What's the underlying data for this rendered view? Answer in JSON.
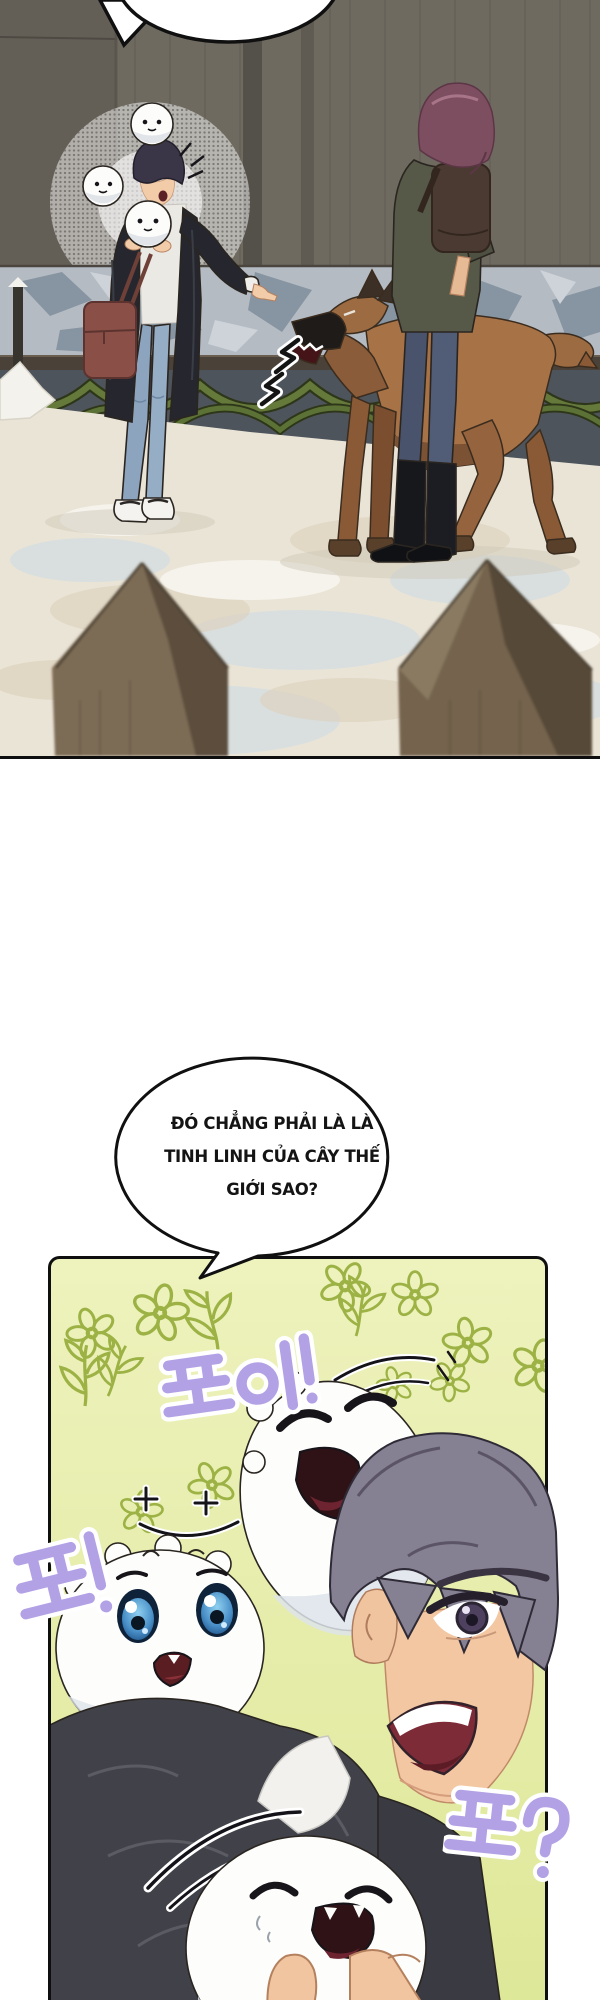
{
  "speech_bubble": {
    "line1": "ĐÓ CHẲNG PHẢI LÀ LÀ",
    "line2": "TINH LINH CỦA CÂY THẾ",
    "line3": "GIỚI SAO?"
  },
  "sfx": {
    "poi": "포이!",
    "po": "포!",
    "po_question": "포?"
  },
  "colors": {
    "sfx_lavender": "#b3a1e6",
    "flower_green": "#9cb245",
    "panel2_bg_top": "#eef2bd",
    "panel2_bg_bottom": "#dde796",
    "wood_wall": "#6f6a60",
    "camo_band": "#b4bbc3",
    "garland_green": "#64793a",
    "snow_floor": "#eae4d7",
    "dog_brown": "#a87247",
    "bag_brown": "#8a5048",
    "jeans_blue": "#8ca4be",
    "bubble_outline": "#101010"
  }
}
